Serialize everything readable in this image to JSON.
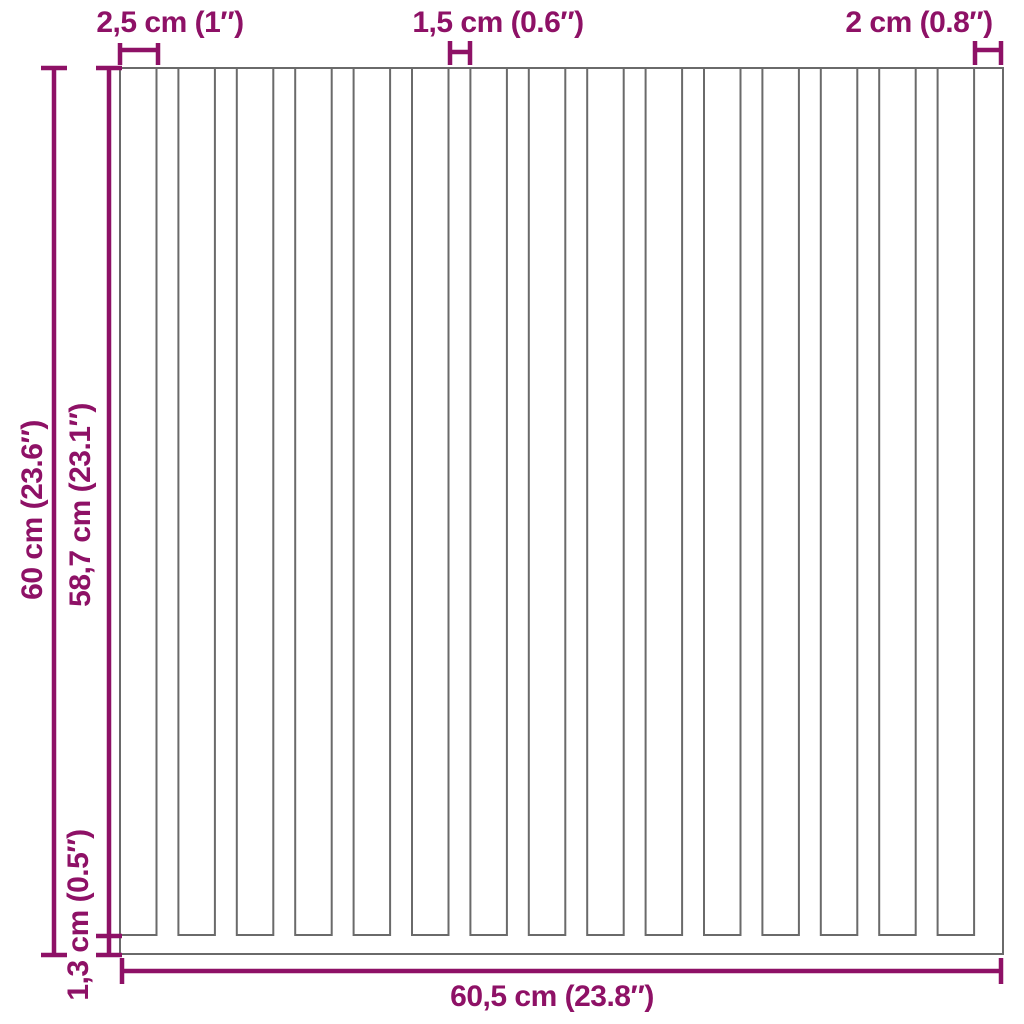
{
  "diagram": {
    "type": "product-dimension-diagram",
    "subject": "slatted wall panel with bottom rail",
    "panel": {
      "slat_count": 15,
      "gap_count": 14,
      "has_right_edge_strip": true
    },
    "dimensions": {
      "slat_width": {
        "label": "2,5 cm (1″)",
        "value_cm": 2.5
      },
      "gap_width": {
        "label": "1,5 cm (0.6″)",
        "value_cm": 1.5
      },
      "edge_width": {
        "label": "2 cm (0.8″)",
        "value_cm": 2
      },
      "total_height": {
        "label": "60 cm (23.6″)",
        "value_cm": 60
      },
      "slat_height": {
        "label": "58,7 cm (23.1″)",
        "value_cm": 58.7
      },
      "rail_height": {
        "label": "1,3 cm (0.5″)",
        "value_cm": 1.3
      },
      "total_width": {
        "label": "60,5 cm (23.8″)",
        "value_cm": 60.5
      }
    },
    "colors": {
      "dimension_accent": "#8E1166",
      "panel_outline": "#6A6A6A",
      "background": "#FFFFFF"
    }
  }
}
